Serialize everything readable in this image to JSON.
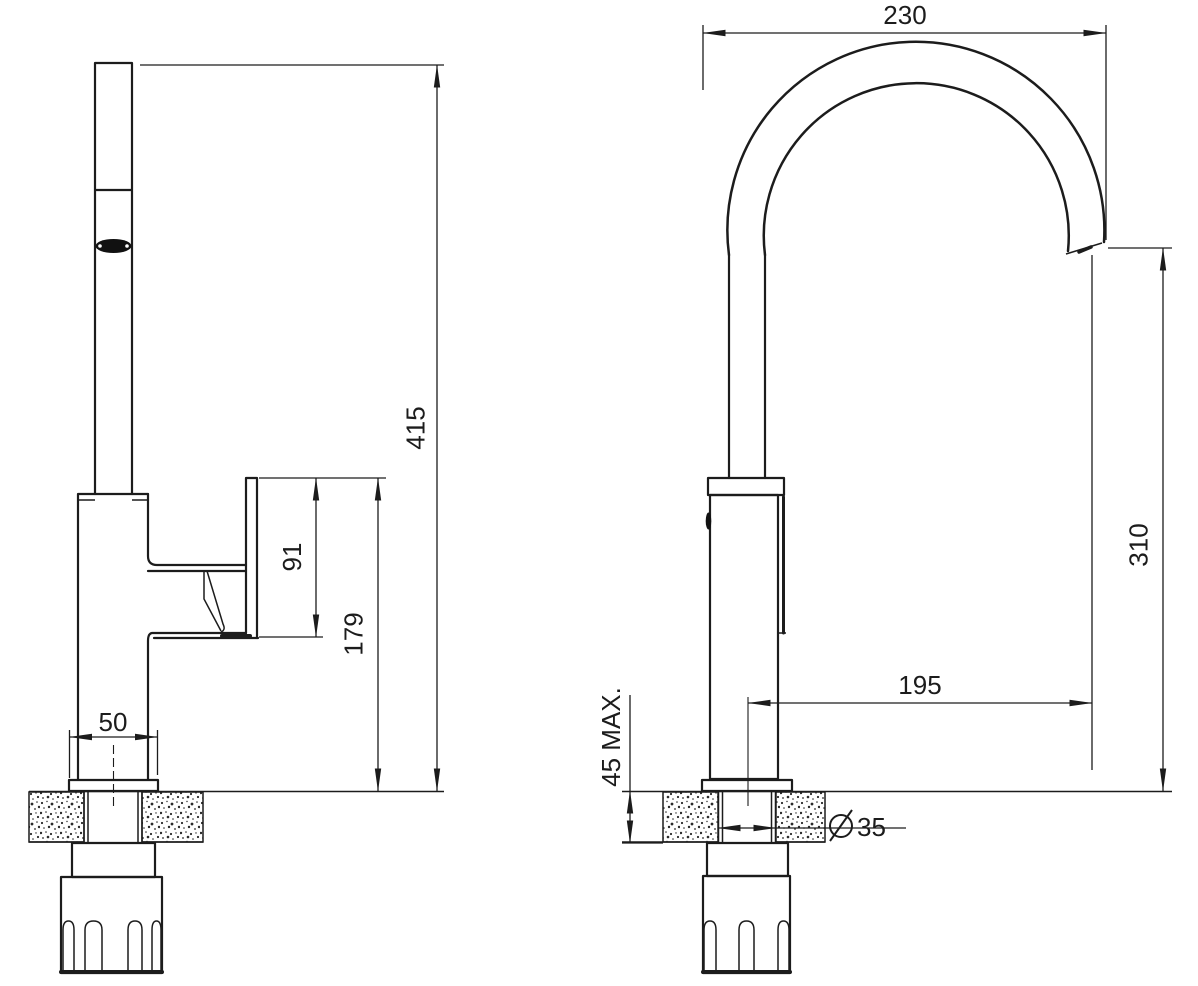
{
  "drawing": {
    "background_color": "#ffffff",
    "line_color": "#1c1c1c",
    "dimensions": {
      "side_view": {
        "total_height": "415",
        "handle_section_height": "91",
        "handle_top_to_deck": "179",
        "base_width": "50"
      },
      "front_view": {
        "spout_reach": "230",
        "spout_outlet_height": "310",
        "spout_projection": "195",
        "deck_thickness_max": "45 MAX.",
        "hole_diameter_label": "⌀35",
        "hole_diameter_value": "35"
      }
    }
  }
}
